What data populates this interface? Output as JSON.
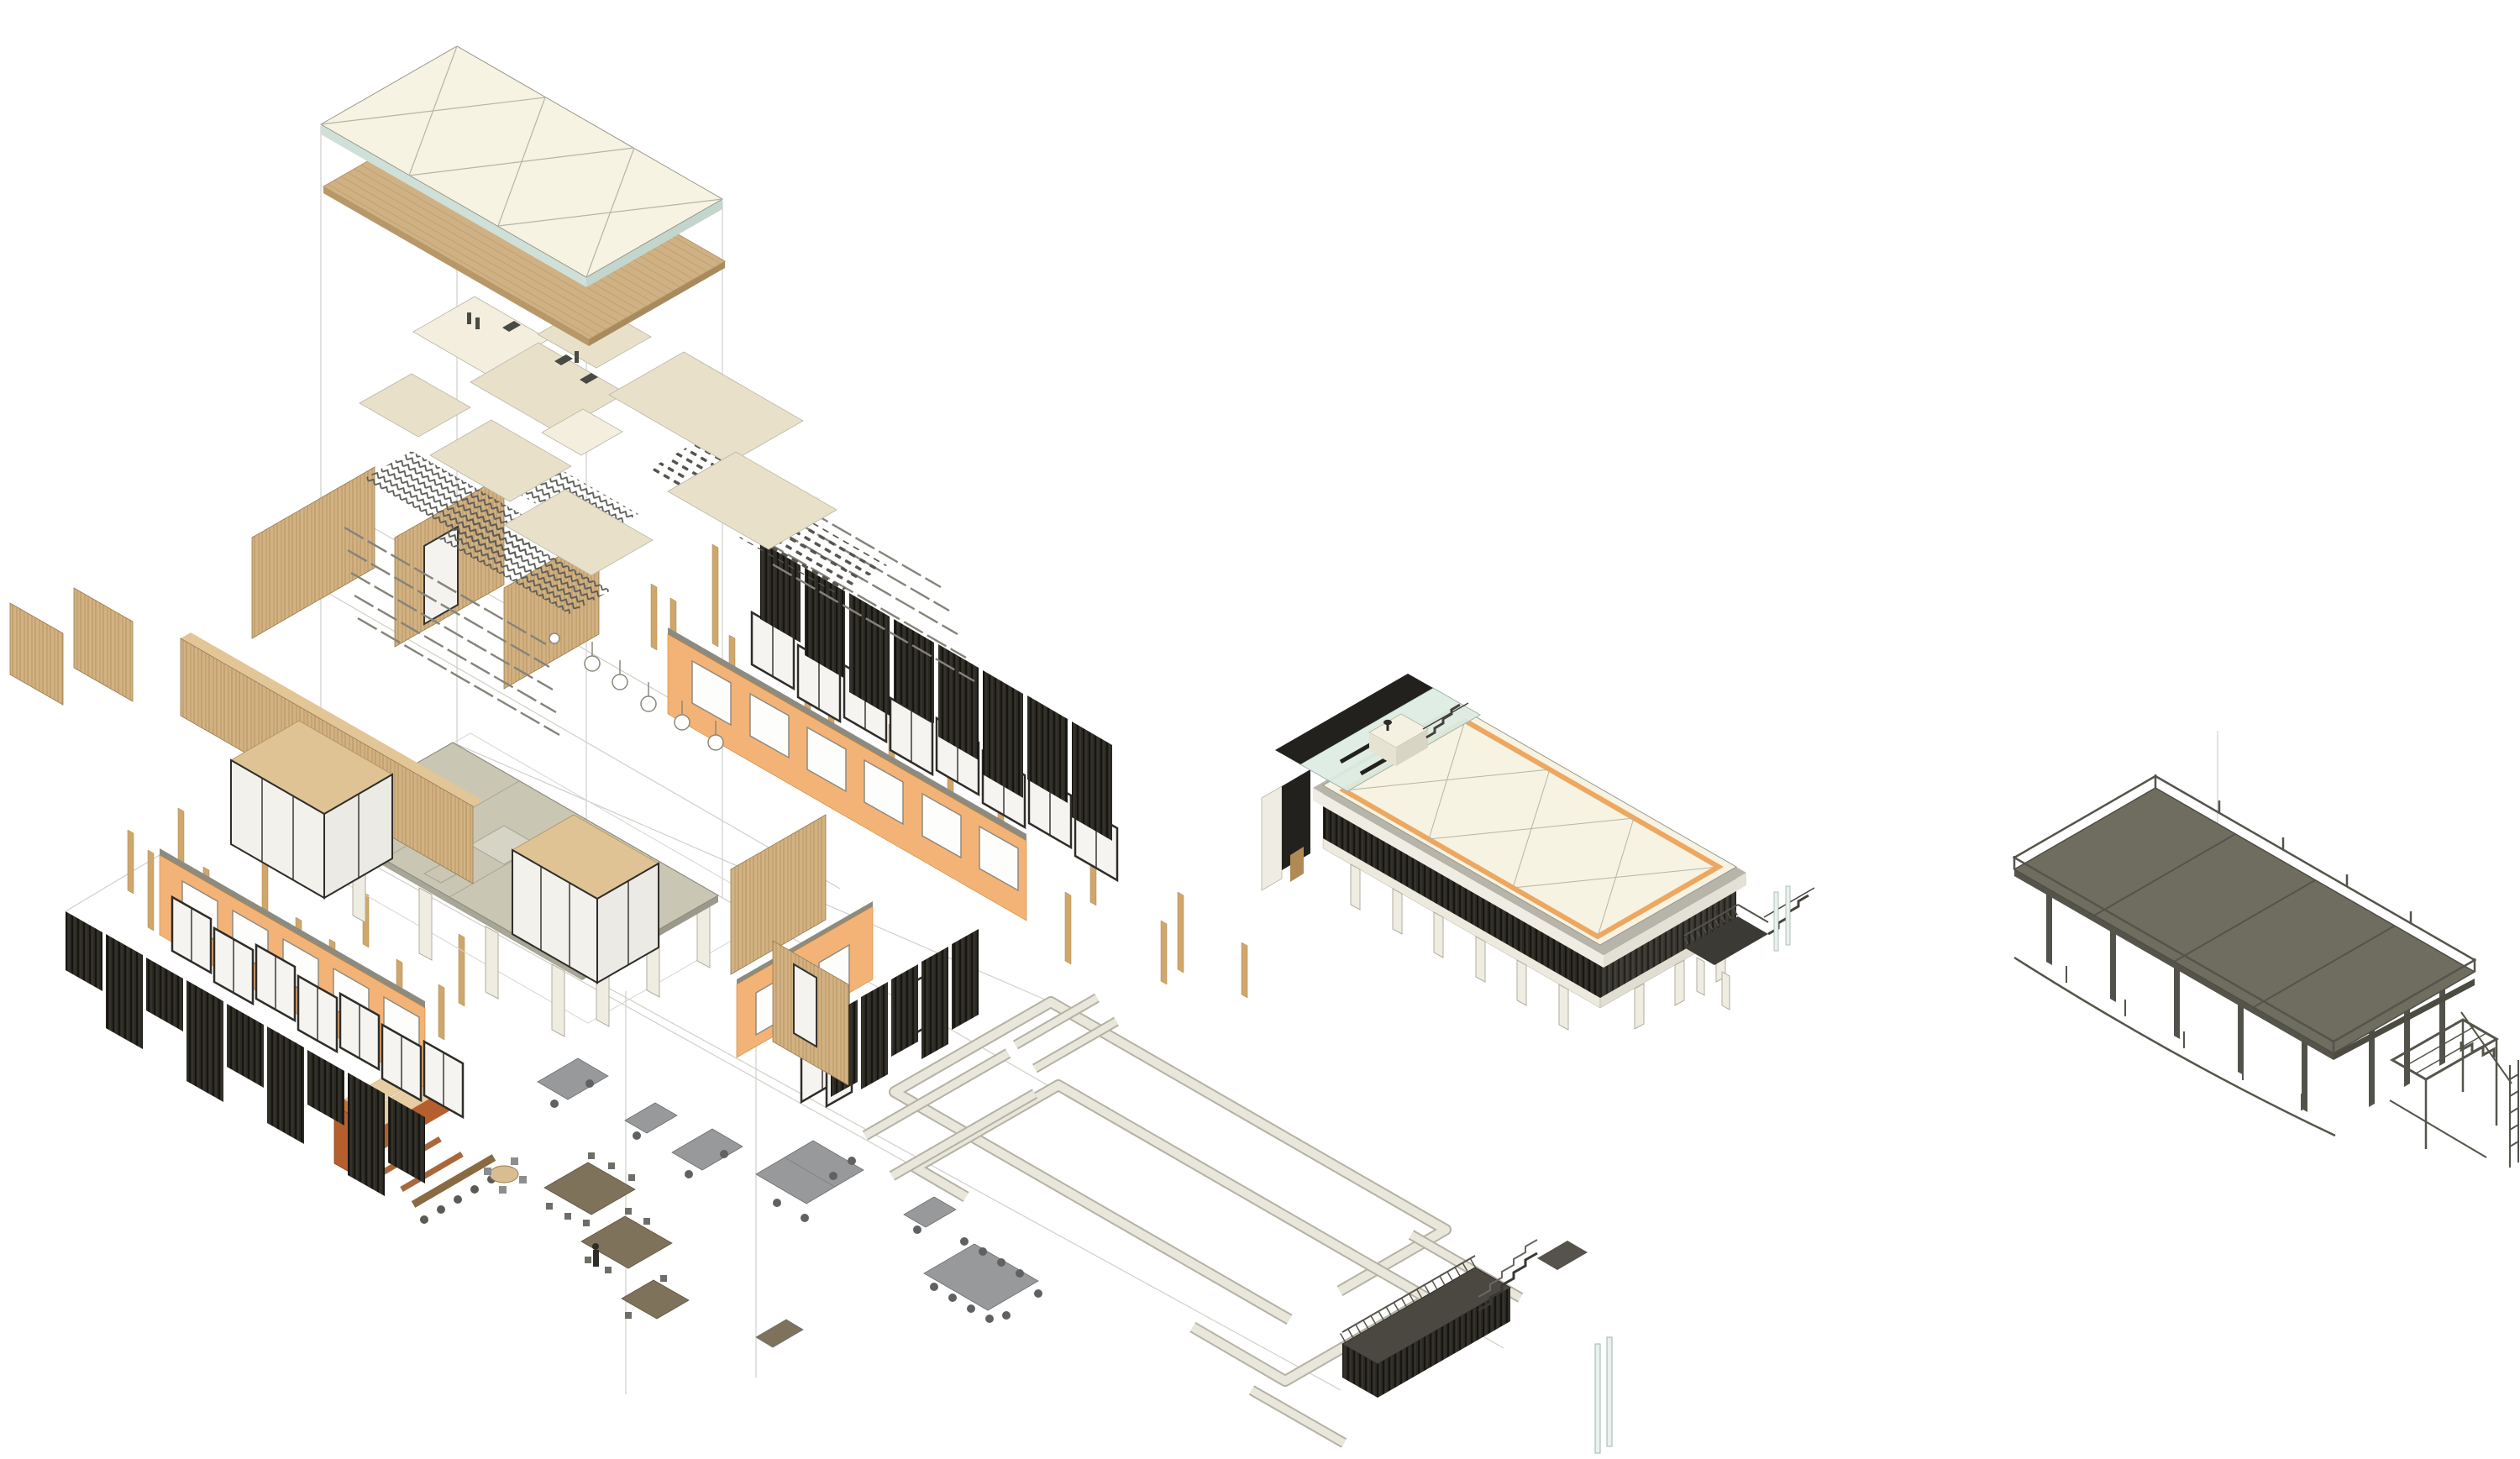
{
  "diagram": {
    "kind": "architectural-exploded-axonometric",
    "views": [
      {
        "id": "exploded-assembly",
        "role": "exploded layer stack of timber-frame building",
        "components": [
          "roof-membrane",
          "timber-roof-deck",
          "ceiling-panels",
          "suspended-hardware",
          "joist-trusses",
          "beam-grid",
          "pendant-lights",
          "interior-wood-partitions",
          "glass-partitions",
          "north-facade-orange-band",
          "north-facade-window-band",
          "north-facade-louver-screen",
          "wood-studs",
          "floor-slab",
          "slab-columns",
          "south-facade-louver-screen",
          "south-facade-window-band",
          "south-facade-orange-band",
          "end-wall-orange-band",
          "end-wall-windows",
          "end-wall-louvers",
          "furniture-kitchen",
          "furniture-desks",
          "furniture-tables",
          "ground-edge-beams",
          "entry-deck",
          "entry-stair",
          "glass-posts",
          "projection-guide-lines"
        ]
      },
      {
        "id": "assembled-building",
        "role": "fully assembled model",
        "components": [
          "membrane-roof",
          "orange-roof-trim",
          "gray-fascia",
          "rooftop-glass-court",
          "black-canopy",
          "roof-access-box",
          "roof-stair",
          "louver-facade",
          "white-parapet",
          "pilotis-columns",
          "end-bay-glazing",
          "entry-deck",
          "entry-stair",
          "glass-pipes"
        ]
      },
      {
        "id": "structural-frame",
        "role": "structure-only model",
        "components": [
          "deck-slab-panels",
          "perimeter-guardrail",
          "edge-beams",
          "steel-columns",
          "sagging-edge-rail",
          "stair-module",
          "service-ladder"
        ]
      }
    ]
  },
  "colors": {
    "roof": "#f6f3e2",
    "glass": "#dcebe3",
    "deck": "#cfb184",
    "panel": "#e9e0c9",
    "panelLight": "#f3eedd",
    "orange": "#f3b377",
    "orangeEdge": "#c9882f",
    "louver": "#2b2924",
    "louverLight": "#3b3831",
    "wood": "#d2b283",
    "woodDark": "#b08a55",
    "slab": "#c9c7b4",
    "white": "#f2f0e6",
    "steel": "#6e6d60",
    "steelDark": "#53524a",
    "furnGray": "#97999b",
    "furnBrown": "#7e725b",
    "furnOrange": "#b55f2e",
    "groundBeam": "#e9e7db",
    "deckDark": "#3a3833",
    "line": "#8e8c80",
    "guide": "#cfcfca",
    "trimOrange": "#eda75f"
  }
}
